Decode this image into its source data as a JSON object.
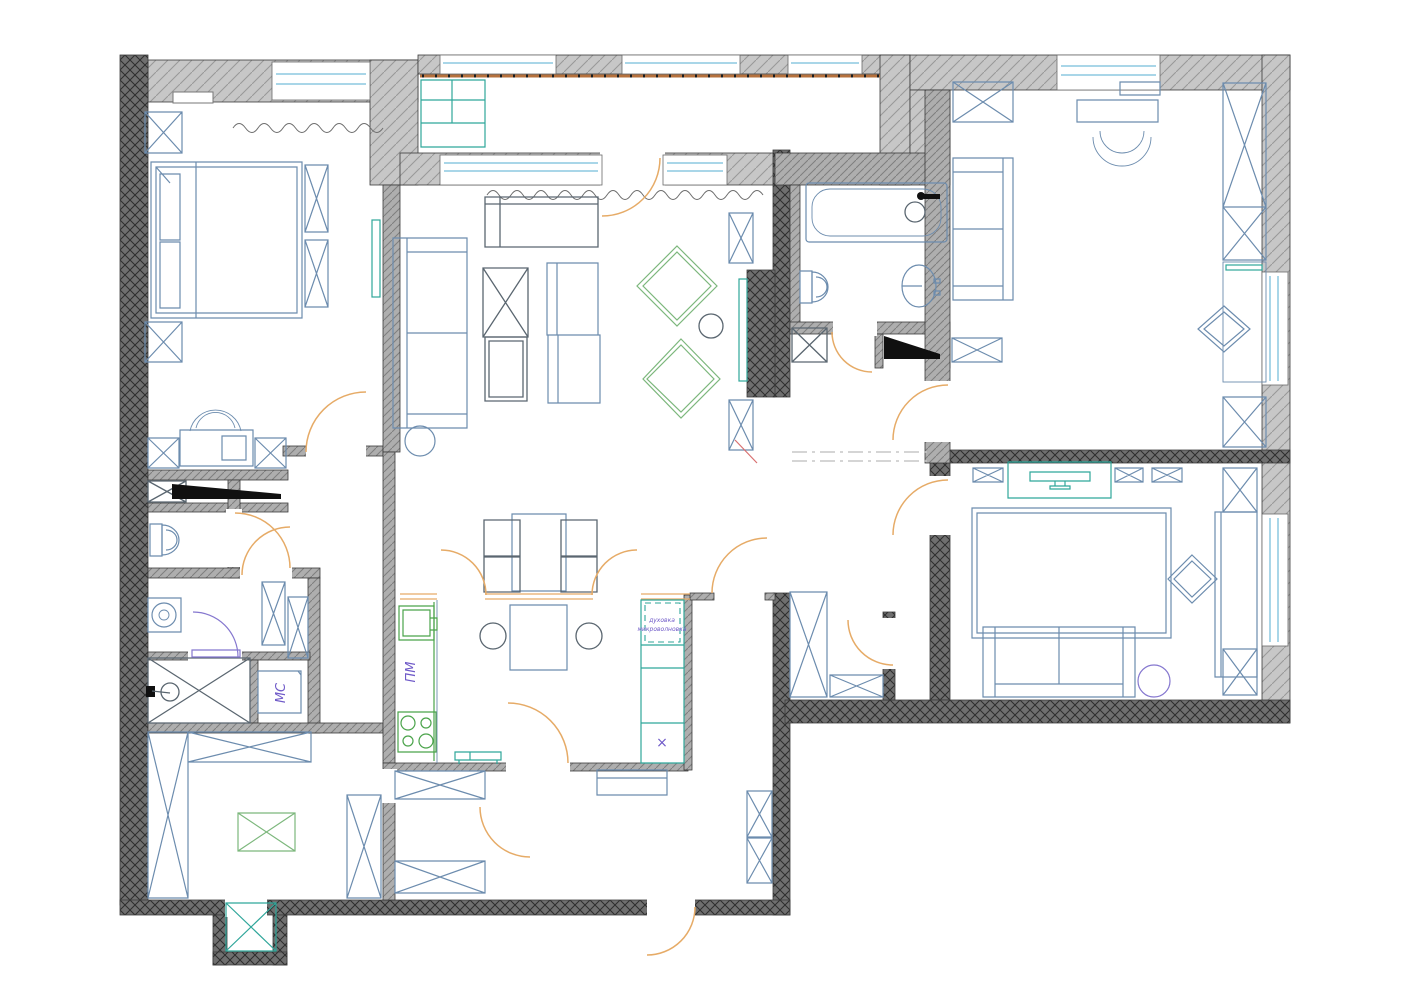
{
  "labels": {
    "dishwasher": "ПМ",
    "washer": "МС",
    "oven_line1": "духовка",
    "oven_line2": "микроволновка",
    "fridge_mark": "×"
  },
  "colors": {
    "wall_dark": "#6f6f6f",
    "wall_mid": "#aeaeae",
    "wall_light": "#c7c7c7",
    "hatch_dark": "#2d2d2d",
    "hatch_mid": "#7e7e7e",
    "hatch_light": "#989898",
    "line_black": "#3a3a3a",
    "furniture_blue": "#6c8cae",
    "furniture_dark": "#5a6670",
    "fixture_green": "#4aa34a",
    "appliance_teal": "#2fa69a",
    "accent_green": "#7cb77c",
    "door_orange": "#e6ab67",
    "door_purple": "#8577cf",
    "text_purple": "#6f5ac8",
    "window_blue": "#a9d6e8",
    "railing_brown": "#b5713d",
    "dash_gray": "#c7c7c7",
    "accent_red": "#d97070"
  }
}
